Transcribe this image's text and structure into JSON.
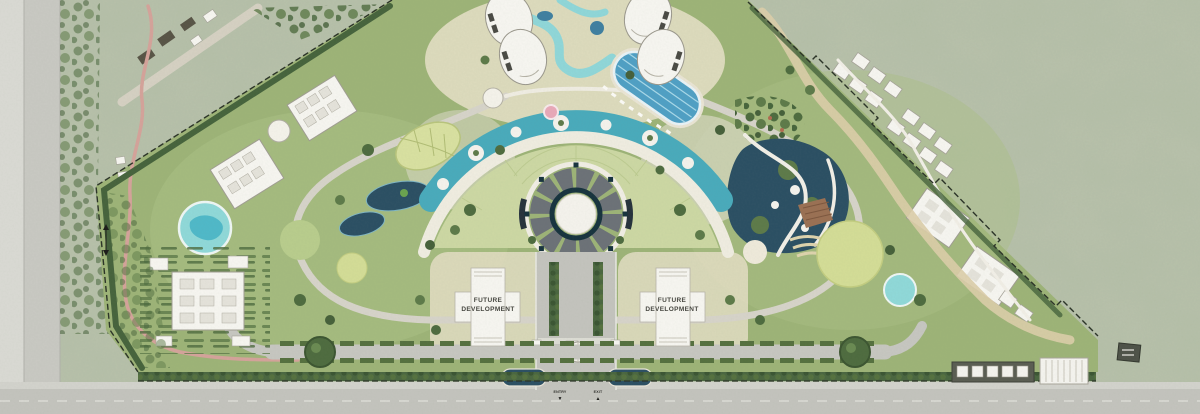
{
  "plan": {
    "labels": {
      "future_line1": "FUTURE",
      "future_line2": "DEVELOPMENT",
      "entry": "ENTRY",
      "exit": "EXIT",
      "entry_arrow": "▼",
      "exit_arrow": "▲"
    }
  },
  "colors": {
    "context": "#b7c0aa",
    "site": "#9db377",
    "site_light": "#aabf85",
    "lawn": "#ccd7a3",
    "yellow_lawn": "#d3dc96",
    "water_dark": "#2b4f63",
    "water_teal": "#49aabb",
    "river": "#8fd6d8",
    "pool": "#4f9fc4",
    "splash": "#8fd8d8",
    "road": "#c3c3bd",
    "street": "#c7c7c1",
    "path_white": "#f1eee6",
    "plaza": "#e2ded0",
    "building": "#f6f5f0",
    "building_stroke": "#a5a298",
    "hedge": "#4a6640",
    "tree": "#55713f",
    "tree_dark": "#3f5a37",
    "trail_pink": "#d4a29a",
    "sand": "#e7e0c8",
    "sand_trail": "#dbcda8",
    "plaza_ring": "#6c7177",
    "accent_teal": "#17333e",
    "boundary": "#2b3327",
    "deck": "#9a7053"
  }
}
